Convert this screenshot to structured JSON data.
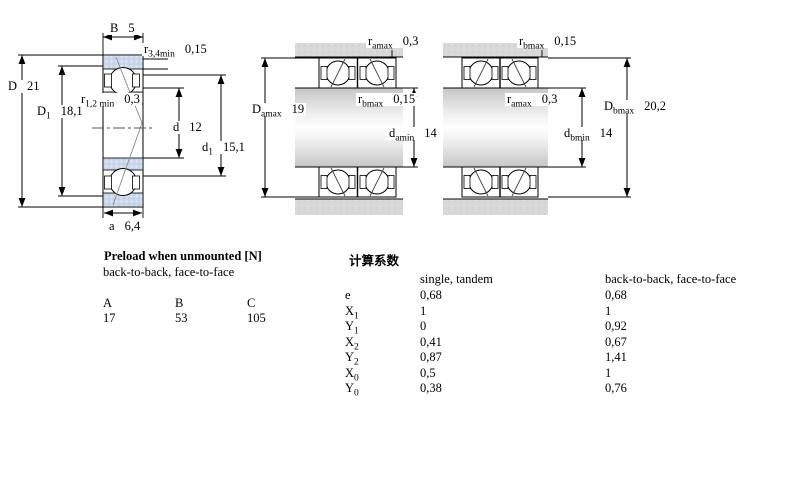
{
  "drawing": {
    "colors": {
      "ring_fill": "#cbd8ec",
      "housing_gray": "#d8d8d8",
      "line": "#000000"
    },
    "left_figure": {
      "description": "single bearing cross-section",
      "dims": {
        "B": {
          "base": "B",
          "sub": "",
          "value": "5"
        },
        "r34min": {
          "base": "r",
          "sub": "3,4min",
          "value": "0,15"
        },
        "D": {
          "base": "D",
          "sub": "",
          "value": "21"
        },
        "r12min": {
          "base": "r",
          "sub": "1,2 min",
          "value": "0,3"
        },
        "D1": {
          "base": "D",
          "sub": "1",
          "value": "18,1"
        },
        "d": {
          "base": "d",
          "sub": "",
          "value": "12"
        },
        "d1": {
          "base": "d",
          "sub": "1",
          "value": "15,1"
        },
        "a": {
          "base": "a",
          "sub": "",
          "value": "6,4"
        }
      }
    },
    "middle_figure": {
      "description": "paired mounting arrangement a",
      "dims": {
        "ramax": {
          "base": "r",
          "sub": "amax",
          "value": "0,3"
        },
        "rbmax": {
          "base": "r",
          "sub": "bmax",
          "value": "0,15"
        },
        "Damax": {
          "base": "D",
          "sub": "amax",
          "value": "19"
        },
        "damin": {
          "base": "d",
          "sub": "amin",
          "value": "14"
        }
      }
    },
    "right_figure": {
      "description": "paired mounting arrangement b",
      "dims": {
        "rbmax": {
          "base": "r",
          "sub": "bmax",
          "value": "0,15"
        },
        "ramax": {
          "base": "r",
          "sub": "amax",
          "value": "0,3"
        },
        "Dbmax": {
          "base": "D",
          "sub": "bmax",
          "value": "20,2"
        },
        "dbmin": {
          "base": "d",
          "sub": "bmin",
          "value": "14"
        }
      }
    }
  },
  "preload_table": {
    "title": "Preload when unmounted [N]",
    "subtitle": "back-to-back, face-to-face",
    "columns": [
      "A",
      "B",
      "C"
    ],
    "values": [
      "17",
      "53",
      "105"
    ]
  },
  "calculation_factors": {
    "title": "计算系数",
    "col1_header": "single, tandem",
    "col2_header": "back-to-back, face-to-face",
    "rows": [
      {
        "base": "e",
        "sub": "",
        "single": "0,68",
        "paired": "0,68"
      },
      {
        "base": "X",
        "sub": "1",
        "single": "1",
        "paired": "1"
      },
      {
        "base": "Y",
        "sub": "1",
        "single": "0",
        "paired": "0,92"
      },
      {
        "base": "X",
        "sub": "2",
        "single": "0,41",
        "paired": "0,67"
      },
      {
        "base": "Y",
        "sub": "2",
        "single": "0,87",
        "paired": "1,41"
      },
      {
        "base": "X",
        "sub": "0",
        "single": "0,5",
        "paired": "1"
      },
      {
        "base": "Y",
        "sub": "0",
        "single": "0,38",
        "paired": "0,76"
      }
    ]
  }
}
